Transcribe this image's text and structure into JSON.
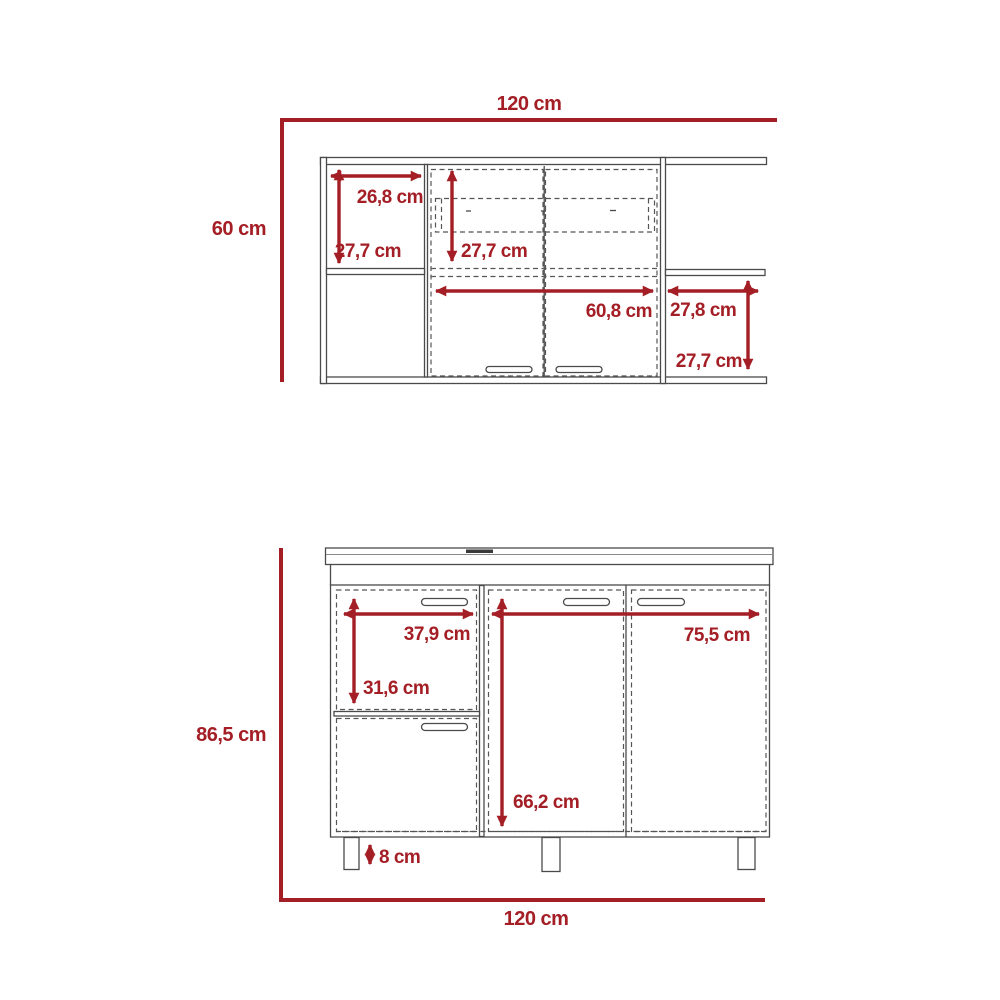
{
  "drawing": {
    "units": "cm",
    "colors": {
      "dimension_color": "#A41E25",
      "outline_color": "#4A4A4A"
    },
    "upper_cabinet": {
      "overall_width": "120 cm",
      "overall_height": "60 cm",
      "left_shelf_width": "26,8 cm",
      "left_shelf_height": "27,7 cm",
      "center_interior_height": "27,7 cm",
      "center_section_width": "60,8 cm",
      "right_shelf_width": "27,8 cm",
      "right_shelf_height": "27,7 cm"
    },
    "lower_cabinet": {
      "overall_width": "120 cm",
      "overall_height": "86,5 cm",
      "drawer_width": "37,9 cm",
      "drawer_section_height": "31,6 cm",
      "doors_section_width": "75,5 cm",
      "door_interior_height": "66,2 cm",
      "leg_height": "8 cm"
    }
  }
}
